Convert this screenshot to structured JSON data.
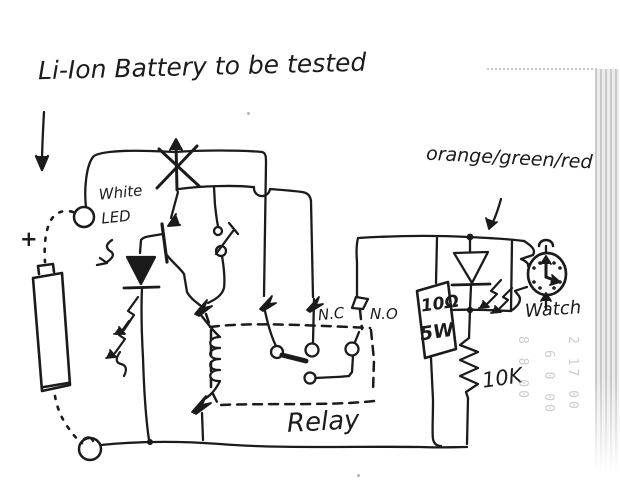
{
  "colors": {
    "ink": "#1b1b1b",
    "paper": "#ffffff",
    "bleedthrough_gray": "#9a9a9a",
    "page_edge_gray": "#c9c9c9"
  },
  "title": {
    "text": "Li-Ion Battery to be tested"
  },
  "battery": {
    "polarity": "+"
  },
  "labels": {
    "white_led": "White LED",
    "nc_contact": "N.C",
    "no_contact": "N.O",
    "relay": "Relay",
    "power_resistor_value": "10Ω",
    "power_resistor_wattage": "5W",
    "sense_resistor": "10K",
    "indicator_led_colors": "orange/green/red",
    "watch": "Watch"
  },
  "bleedthrough": {
    "columns": [
      "8 8 00",
      "6 0 00",
      "2 17 00"
    ]
  }
}
